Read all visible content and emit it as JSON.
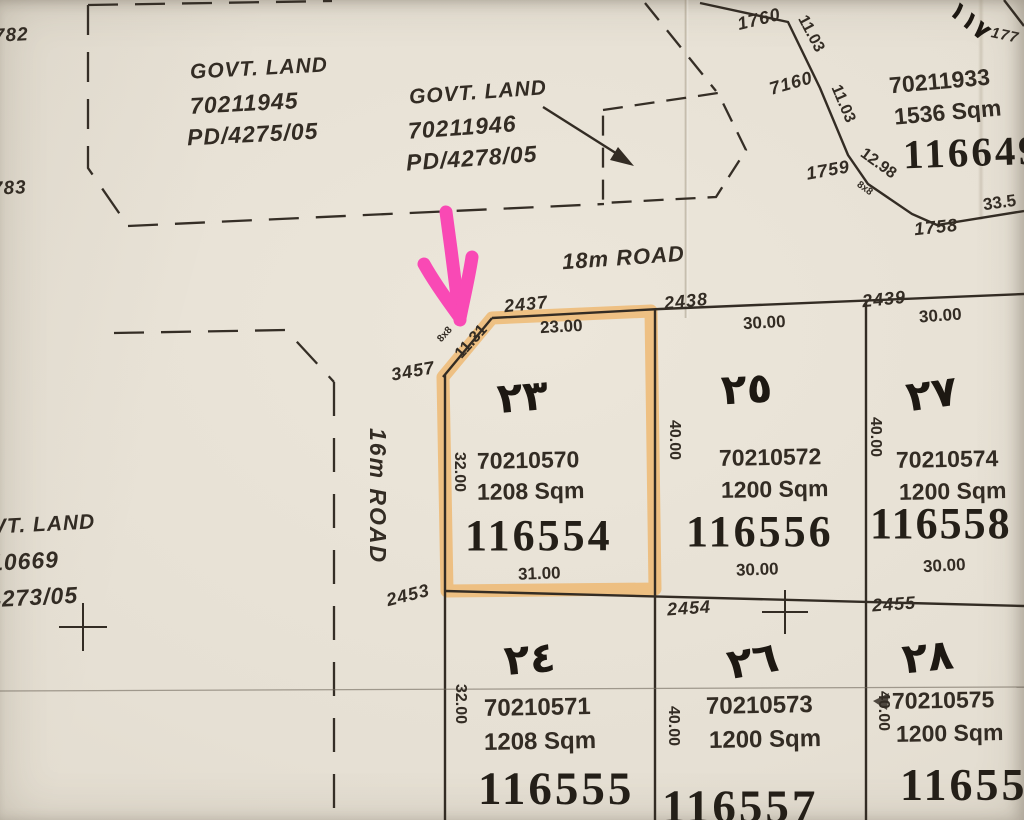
{
  "colors": {
    "paper": "#e7e1d5",
    "ink": "#332c24",
    "stamp": "#241f18",
    "highlight": "#f0a23c",
    "arrow_pink": "#fb3cb2"
  },
  "roads": {
    "r18": "18m ROAD",
    "r16": "16m ROAD"
  },
  "govt": {
    "g1": {
      "title": "GOVT. LAND",
      "parcel": "70211945",
      "ref": "PD/4275/05"
    },
    "g2": {
      "title": "GOVT. LAND",
      "parcel": "70211946",
      "ref": "PD/4278/05"
    },
    "g3": {
      "title": "VT. LAND",
      "parcel": "10669",
      "ref": "4273/05"
    }
  },
  "neighbor": {
    "parcel": "70211933",
    "area": "1536 Sqm",
    "cert": "116649",
    "arabic_no": "١١٧",
    "latin_no": "177"
  },
  "plots": {
    "p23": {
      "no": "٢٣",
      "parcel": "70210570",
      "area": "1208 Sqm",
      "cert": "116554",
      "dim_top": "23.00",
      "dim_bottom": "31.00",
      "dim_left": "32.00",
      "dim_chamfer": "11.31",
      "corner_cut": "8x8"
    },
    "p25": {
      "no": "٢٥",
      "parcel": "70210572",
      "area": "1200 Sqm",
      "cert": "116556",
      "dim_top": "30.00",
      "dim_bottom": "30.00",
      "dim_left": "40.00"
    },
    "p27": {
      "no": "٢٧",
      "parcel": "70210574",
      "area": "1200 Sqm",
      "cert": "116558",
      "dim_top": "30.00",
      "dim_bottom": "30.00",
      "dim_left": "40.00"
    },
    "p24": {
      "no": "٢٤",
      "parcel": "70210571",
      "area": "1208 Sqm",
      "cert": "116555",
      "dim_left": "32.00"
    },
    "p26": {
      "no": "٢٦",
      "parcel": "70210573",
      "area": "1200 Sqm",
      "cert": "116557",
      "dim_left": "40.00"
    },
    "p28": {
      "no": "٢٨",
      "parcel": "70210575",
      "area": "1200 Sqm",
      "cert": "11655",
      "dim_left": "40.00"
    }
  },
  "corners": {
    "c782": "782",
    "c783": "783",
    "c1758": "1758",
    "c1759": "1759",
    "c1760": "1760",
    "c2437": "2437",
    "c2438": "2438",
    "c2439": "2439",
    "c2453": "2453",
    "c2454": "2454",
    "c2455": "2455",
    "c3457": "3457",
    "c7160": "7160"
  },
  "dims": {
    "d1103a": "11.03",
    "d1103b": "11.03",
    "d1298": "12.98",
    "d335": "33.5",
    "d8x8": "8x8"
  }
}
